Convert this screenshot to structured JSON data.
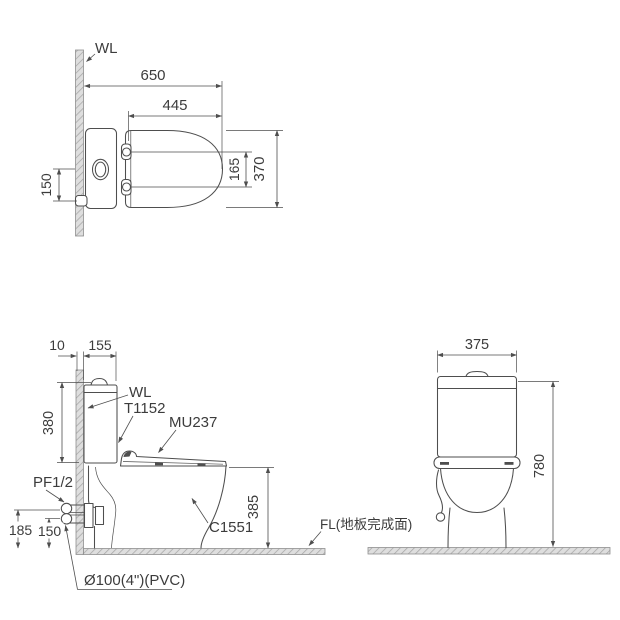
{
  "colors": {
    "line": "#4e4e4e",
    "text": "#3c3c3c",
    "hatch_base": "#dedede",
    "hatch_line": "#a6a6a6",
    "background": "#ffffff"
  },
  "views": {
    "top": {
      "wall_label": "WL",
      "dim_overall_depth": "650",
      "dim_seat_depth": "445",
      "dim_hinge_spacing": "165",
      "dim_seat_width": "370",
      "dim_supply_offset": "150"
    },
    "side": {
      "dim_wall_thickness": "10",
      "dim_tank_depth": "155",
      "dim_tank_height": "380",
      "wall_label": "WL",
      "tank_model": "T1152",
      "seat_model": "MU237",
      "supply_label": "PF1/2",
      "dim_supply_height": "185",
      "dim_outlet_height": "150",
      "bowl_model": "C1551",
      "dim_rim_height": "385",
      "outlet_label": "Ø100(4\")(PVC)",
      "floor_label": "FL(地板完成面)"
    },
    "front": {
      "dim_width": "375",
      "dim_height": "780"
    }
  }
}
